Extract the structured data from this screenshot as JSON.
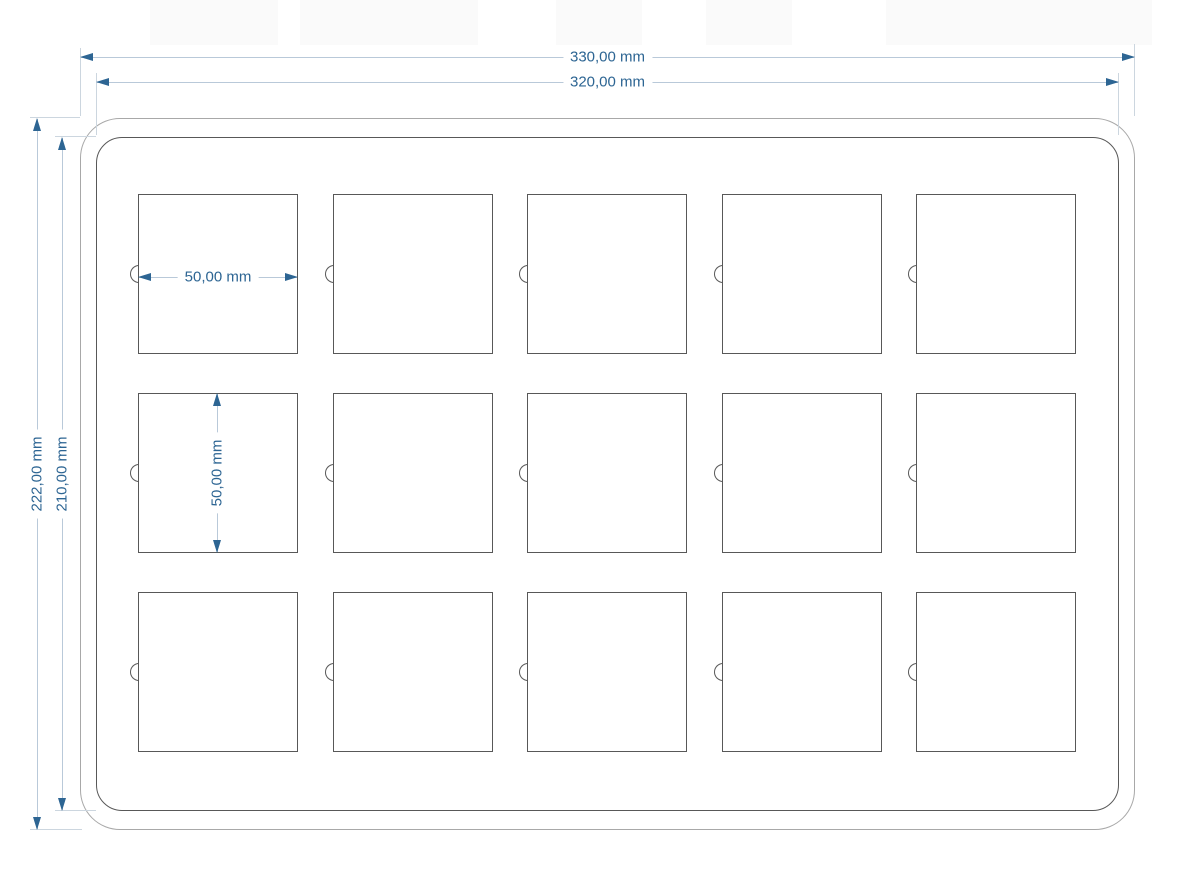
{
  "drawing": {
    "type": "technical-drawing",
    "units": "mm",
    "dimensions": {
      "outer_width": {
        "label": "330,00 mm",
        "value": 330.0
      },
      "inner_width": {
        "label": "320,00 mm",
        "value": 320.0
      },
      "outer_height": {
        "label": "222,00 mm",
        "value": 222.0
      },
      "inner_height": {
        "label": "210,00 mm",
        "value": 210.0
      },
      "pocket_width": {
        "label": "50,00 mm",
        "value": 50.0
      },
      "pocket_height": {
        "label": "50,00 mm",
        "value": 50.0
      }
    },
    "grid": {
      "rows": 3,
      "cols": 5
    },
    "colors": {
      "dim_accent": "#2d6593",
      "dim_line": "#b9c9d9",
      "ext_line": "#ccd6df",
      "outline_outer": "#a8a8a8",
      "outline_inner": "#585858",
      "pocket_line": "#585858",
      "background": "#ffffff"
    }
  }
}
